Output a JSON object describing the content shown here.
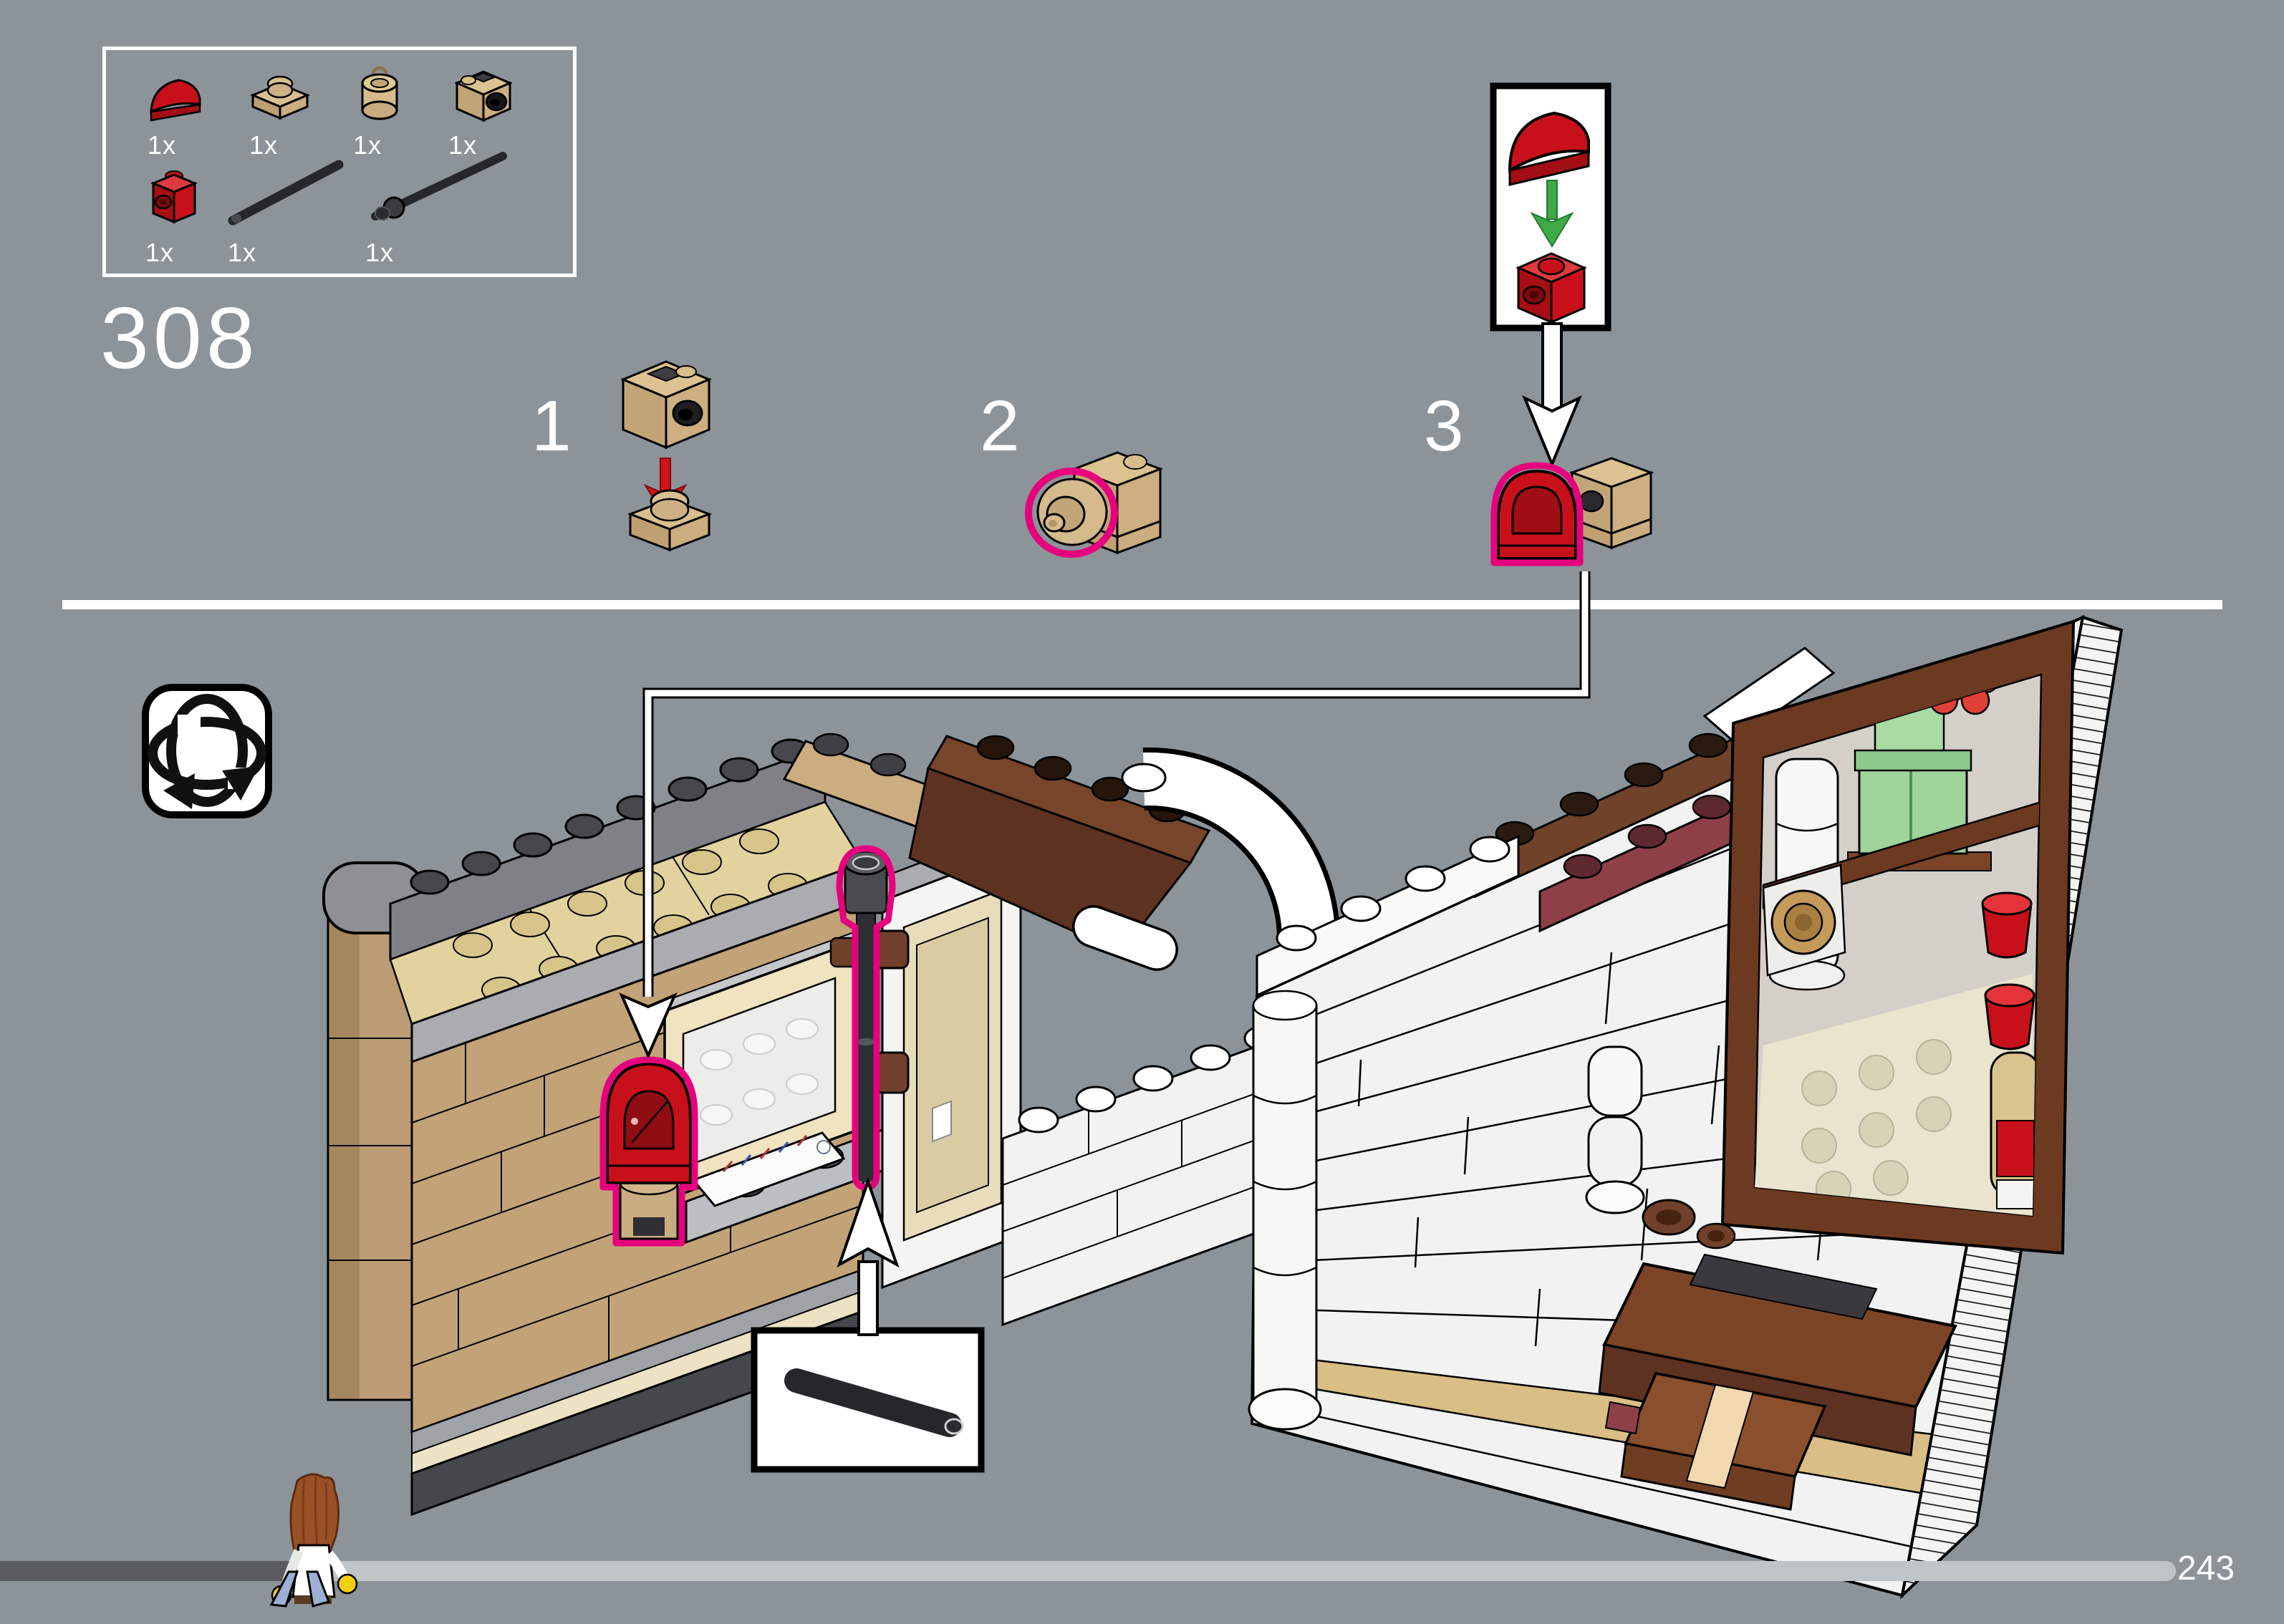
{
  "page": {
    "title": "LEGO building instructions page",
    "step_number": "308",
    "page_number": "243",
    "background_color": "#8C949A"
  },
  "parts_panel": {
    "parts": [
      {
        "name": "slope-curved-1x1-red",
        "qty": "1x",
        "color": "#C8101A"
      },
      {
        "name": "plate-1x1-tan",
        "qty": "1x",
        "color": "#D9BF8E"
      },
      {
        "name": "brick-round-1x1-tan",
        "qty": "1x",
        "color": "#D5BA8C"
      },
      {
        "name": "brick-1x1-headlight-tan",
        "qty": "1x",
        "color": "#DCC291"
      },
      {
        "name": "brick-1x1-side-stud-red",
        "qty": "1x",
        "color": "#C8101A"
      },
      {
        "name": "bar-4l-black",
        "qty": "1x",
        "color": "#26272B"
      },
      {
        "name": "bar-6l-stop-ring-black",
        "qty": "1x",
        "color": "#26272B"
      }
    ]
  },
  "substeps": [
    {
      "label": "1"
    },
    {
      "label": "2"
    },
    {
      "label": "3"
    }
  ],
  "annotations": {
    "highlight_color": "#E6007E",
    "arrow_red": "#D41317",
    "arrow_green": "#3FA948",
    "callout_line_color": "#FFFFFF",
    "rotate_icon_meaning": "rotate-model"
  },
  "progress": {
    "completed_ratio": 0.14
  }
}
